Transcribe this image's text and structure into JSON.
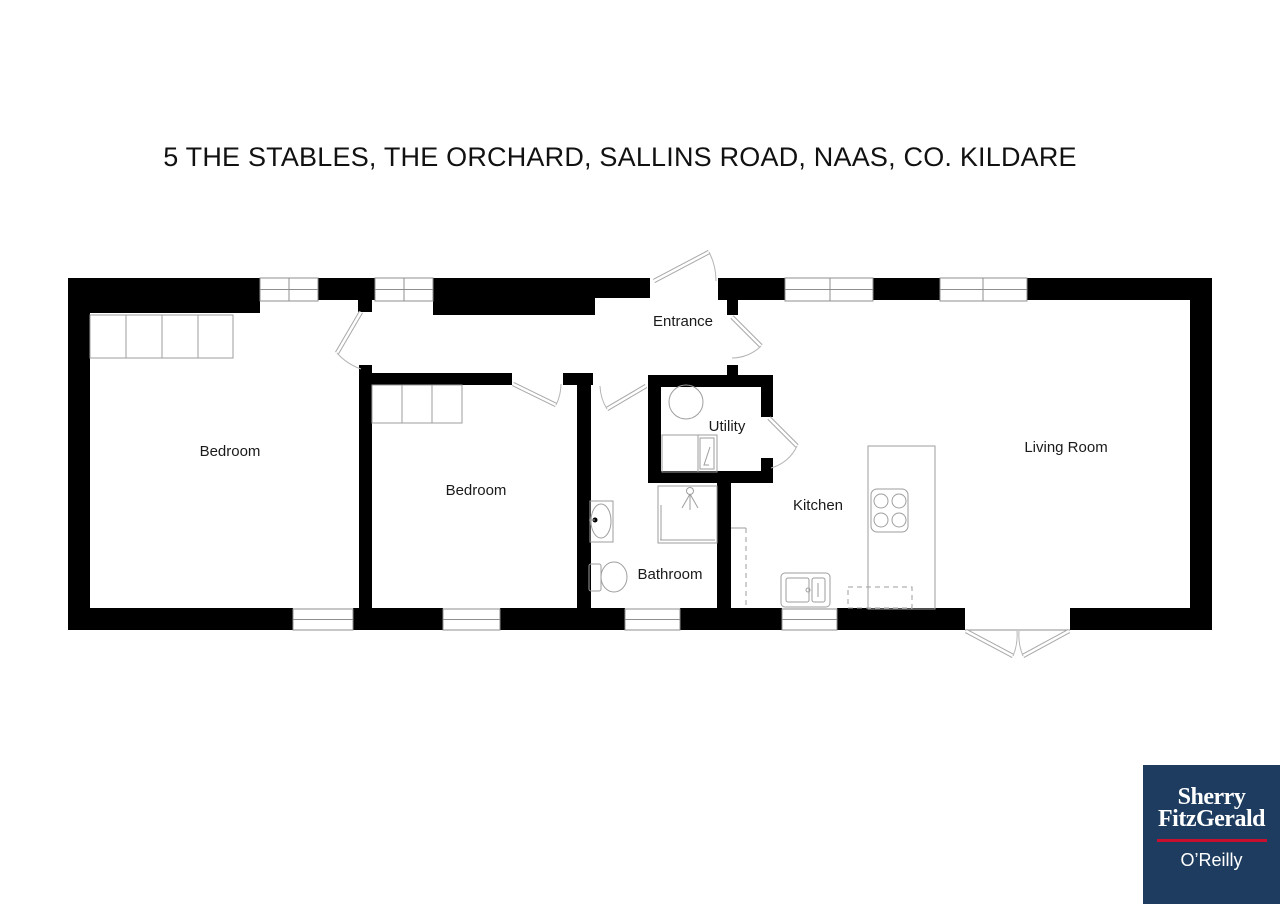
{
  "title": "5 THE STABLES, THE ORCHARD, SALLINS ROAD, NAAS, CO. KILDARE",
  "floorplan": {
    "rooms": [
      {
        "id": "bedroom-1",
        "label": "Bedroom"
      },
      {
        "id": "bedroom-2",
        "label": "Bedroom"
      },
      {
        "id": "entrance",
        "label": "Entrance"
      },
      {
        "id": "utility",
        "label": "Utility"
      },
      {
        "id": "bathroom",
        "label": "Bathroom"
      },
      {
        "id": "kitchen",
        "label": "Kitchen"
      },
      {
        "id": "living-room",
        "label": "Living Room"
      }
    ],
    "wall_color": "#000000",
    "line_color": "#9e9e9e",
    "fixtures": [
      "wardrobe",
      "wardrobe",
      "washing-machine",
      "utility-unit",
      "wash-basin",
      "toilet",
      "shower",
      "hob",
      "kitchen-sink",
      "kitchen-counter",
      "appliance-outline"
    ]
  },
  "logo": {
    "brand_line1": "Sherry",
    "brand_line2": "FitzGerald",
    "sub_brand": "O’Reilly",
    "bg_color": "#1d3c5f",
    "accent_color": "#c8102e",
    "text_color": "#ffffff"
  }
}
